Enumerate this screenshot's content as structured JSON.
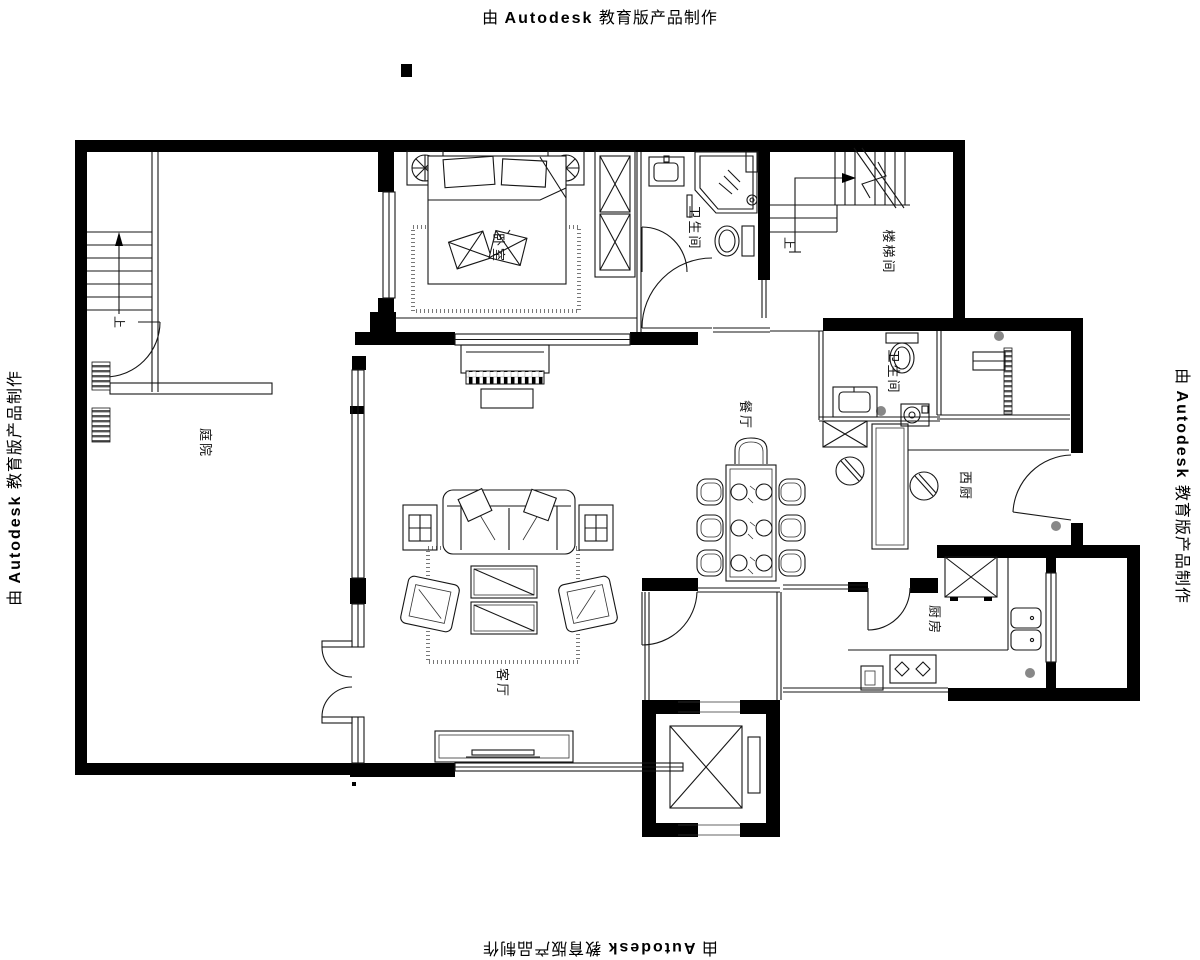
{
  "banner": {
    "prefix": "由",
    "brand": "Autodesk",
    "suffix": "教育版产品制作"
  },
  "rooms": {
    "courtyard": "庭院",
    "bedroom": "卧室",
    "master_bath": "卫生间",
    "stairwell": "楼梯间",
    "small_bath": "卫生间",
    "dining": "餐厅",
    "west_kitchen": "西厨",
    "kitchen": "厨房",
    "living": "客厅"
  },
  "stairs": {
    "up_left": "上",
    "up_stairwell": "上"
  },
  "colors": {
    "wall": "#000000",
    "line": "#161616",
    "background": "#ffffff"
  }
}
